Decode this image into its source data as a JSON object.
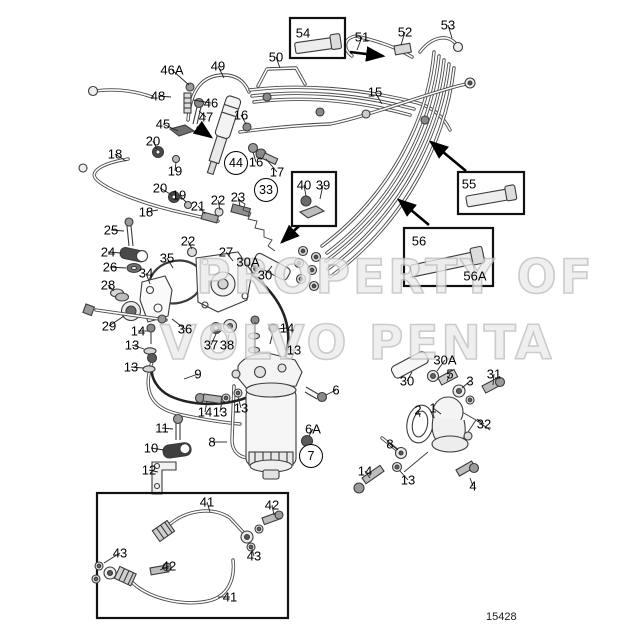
{
  "doc": {
    "drawing_number": "15428",
    "watermark_line1": "PROPERTY OF",
    "watermark_line2": "VOLVO PENTA"
  },
  "labels": [
    {
      "t": "46A",
      "x": 172,
      "y": 70,
      "lx": 189,
      "ly": 85
    },
    {
      "t": "48",
      "x": 158,
      "y": 96,
      "lx": 171,
      "ly": 97
    },
    {
      "t": "49",
      "x": 218,
      "y": 66,
      "lx": 224,
      "ly": 78
    },
    {
      "t": "50",
      "x": 276,
      "y": 57,
      "lx": 280,
      "ly": 68
    },
    {
      "t": "54",
      "x": 303,
      "y": 33
    },
    {
      "t": "51",
      "x": 362,
      "y": 37,
      "lx": 357,
      "ly": 50
    },
    {
      "t": "52",
      "x": 405,
      "y": 32,
      "lx": 401,
      "ly": 45
    },
    {
      "t": "53",
      "x": 448,
      "y": 25,
      "lx": 452,
      "ly": 38
    },
    {
      "t": "46",
      "x": 211,
      "y": 103,
      "lx": 193,
      "ly": 100
    },
    {
      "t": "45",
      "x": 163,
      "y": 124,
      "lx": 178,
      "ly": 131
    },
    {
      "t": "47",
      "x": 206,
      "y": 117,
      "lx": 199,
      "ly": 111
    },
    {
      "t": "16",
      "x": 241,
      "y": 115,
      "lx": 246,
      "ly": 124
    },
    {
      "t": "15",
      "x": 375,
      "y": 92,
      "lx": 382,
      "ly": 104
    },
    {
      "t": "18",
      "x": 115,
      "y": 154,
      "lx": 126,
      "ly": 161
    },
    {
      "t": "20",
      "x": 153,
      "y": 141,
      "lx": 157,
      "ly": 149
    },
    {
      "t": "19",
      "x": 175,
      "y": 171,
      "lx": 176,
      "ly": 162
    },
    {
      "t": "20",
      "x": 160,
      "y": 188,
      "lx": 172,
      "ly": 195
    },
    {
      "t": "19",
      "x": 179,
      "y": 195,
      "lx": 186,
      "ly": 202
    },
    {
      "t": "18",
      "x": 146,
      "y": 212,
      "lx": 158,
      "ly": 210
    },
    {
      "t": "44",
      "x": 236,
      "y": 163,
      "circled": true,
      "lx": 231,
      "ly": 152
    },
    {
      "t": "16",
      "x": 256,
      "y": 162,
      "lx": 253,
      "ly": 152
    },
    {
      "t": "17",
      "x": 277,
      "y": 172,
      "lx": 266,
      "ly": 159
    },
    {
      "t": "21",
      "x": 198,
      "y": 206,
      "lx": 205,
      "ly": 214
    },
    {
      "t": "22",
      "x": 218,
      "y": 200,
      "lx": 220,
      "ly": 210
    },
    {
      "t": "23",
      "x": 238,
      "y": 197,
      "lx": 240,
      "ly": 206
    },
    {
      "t": "33",
      "x": 266,
      "y": 190,
      "circled": true,
      "lx": 261,
      "ly": 201
    },
    {
      "t": "40",
      "x": 304,
      "y": 185,
      "lx": 306,
      "ly": 196
    },
    {
      "t": "39",
      "x": 323,
      "y": 185,
      "lx": 320,
      "ly": 199
    },
    {
      "t": "55",
      "x": 469,
      "y": 184
    },
    {
      "t": "56",
      "x": 419,
      "y": 241
    },
    {
      "t": "56A",
      "x": 475,
      "y": 276,
      "lx": 473,
      "ly": 263
    },
    {
      "t": "25",
      "x": 111,
      "y": 230,
      "lx": 124,
      "ly": 231
    },
    {
      "t": "24",
      "x": 108,
      "y": 252,
      "lx": 121,
      "ly": 253
    },
    {
      "t": "26",
      "x": 110,
      "y": 267,
      "lx": 126,
      "ly": 268
    },
    {
      "t": "28",
      "x": 108,
      "y": 285,
      "lx": 114,
      "ly": 291
    },
    {
      "t": "29",
      "x": 109,
      "y": 326,
      "lx": 124,
      "ly": 316
    },
    {
      "t": "35",
      "x": 167,
      "y": 258,
      "lx": 173,
      "ly": 268
    },
    {
      "t": "34",
      "x": 146,
      "y": 273,
      "lx": 150,
      "ly": 284
    },
    {
      "t": "22",
      "x": 188,
      "y": 241,
      "lx": 192,
      "ly": 249
    },
    {
      "t": "27",
      "x": 226,
      "y": 252,
      "lx": 233,
      "ly": 261
    },
    {
      "t": "30A",
      "x": 248,
      "y": 262,
      "lx": 255,
      "ly": 267
    },
    {
      "t": "30",
      "x": 265,
      "y": 275,
      "lx": 272,
      "ly": 266
    },
    {
      "t": "36",
      "x": 185,
      "y": 329,
      "lx": 172,
      "ly": 319
    },
    {
      "t": "37",
      "x": 211,
      "y": 345,
      "lx": 216,
      "ly": 334
    },
    {
      "t": "38",
      "x": 227,
      "y": 345,
      "lx": 229,
      "ly": 334
    },
    {
      "t": "14",
      "x": 138,
      "y": 331,
      "lx": 148,
      "ly": 331
    },
    {
      "t": "13",
      "x": 132,
      "y": 345,
      "lx": 144,
      "ly": 349
    },
    {
      "t": "13",
      "x": 131,
      "y": 367,
      "lx": 143,
      "ly": 368
    },
    {
      "t": "9",
      "x": 198,
      "y": 374,
      "lx": 184,
      "ly": 379
    },
    {
      "t": "14",
      "x": 287,
      "y": 328,
      "lx": 277,
      "ly": 329
    },
    {
      "t": "13",
      "x": 294,
      "y": 350,
      "lx": 284,
      "ly": 349
    },
    {
      "t": "14",
      "x": 205,
      "y": 412,
      "lx": 207,
      "ly": 401
    },
    {
      "t": "13",
      "x": 220,
      "y": 412,
      "lx": 222,
      "ly": 401
    },
    {
      "t": "13",
      "x": 241,
      "y": 408,
      "lx": 238,
      "ly": 397
    },
    {
      "t": "11",
      "x": 162,
      "y": 428,
      "lx": 173,
      "ly": 429
    },
    {
      "t": "10",
      "x": 151,
      "y": 448,
      "lx": 164,
      "ly": 450
    },
    {
      "t": "12",
      "x": 149,
      "y": 470,
      "lx": 158,
      "ly": 472
    },
    {
      "t": "8",
      "x": 212,
      "y": 442,
      "lx": 227,
      "ly": 442
    },
    {
      "t": "7",
      "x": 311,
      "y": 456,
      "circled": true,
      "lx": 299,
      "ly": 456
    },
    {
      "t": "6",
      "x": 336,
      "y": 390,
      "lx": 326,
      "ly": 395
    },
    {
      "t": "6A",
      "x": 313,
      "y": 429,
      "lx": 309,
      "ly": 436
    },
    {
      "t": "30",
      "x": 407,
      "y": 381,
      "lx": 412,
      "ly": 372
    },
    {
      "t": "30A",
      "x": 445,
      "y": 360,
      "lx": 437,
      "ly": 371
    },
    {
      "t": "5",
      "x": 450,
      "y": 374,
      "lx": 447,
      "ly": 381
    },
    {
      "t": "3",
      "x": 470,
      "y": 381,
      "lx": 462,
      "ly": 388
    },
    {
      "t": "31",
      "x": 494,
      "y": 374,
      "lx": 493,
      "ly": 385
    },
    {
      "t": "2",
      "x": 418,
      "y": 410,
      "lx": 420,
      "ly": 417
    },
    {
      "t": "1",
      "x": 433,
      "y": 408,
      "lx": 441,
      "ly": 414
    },
    {
      "t": "32",
      "x": 484,
      "y": 424,
      "lx": 477,
      "ly": 419
    },
    {
      "t": "8",
      "x": 390,
      "y": 444,
      "lx": 398,
      "ly": 450
    },
    {
      "t": "14",
      "x": 365,
      "y": 471,
      "lx": 370,
      "ly": 478
    },
    {
      "t": "13",
      "x": 408,
      "y": 480,
      "lx": 400,
      "ly": 471
    },
    {
      "t": "4",
      "x": 473,
      "y": 486,
      "lx": 470,
      "ly": 478
    },
    {
      "t": "41",
      "x": 207,
      "y": 502,
      "lx": 210,
      "ly": 512
    },
    {
      "t": "42",
      "x": 272,
      "y": 505,
      "lx": 274,
      "ly": 515
    },
    {
      "t": "43",
      "x": 254,
      "y": 556,
      "lx": 252,
      "ly": 549
    },
    {
      "t": "43",
      "x": 120,
      "y": 553,
      "lx": 104,
      "ly": 563
    },
    {
      "t": "42",
      "x": 169,
      "y": 566,
      "lx": 160,
      "ly": 570
    },
    {
      "t": "41",
      "x": 230,
      "y": 597,
      "lx": 218,
      "ly": 597
    }
  ]
}
